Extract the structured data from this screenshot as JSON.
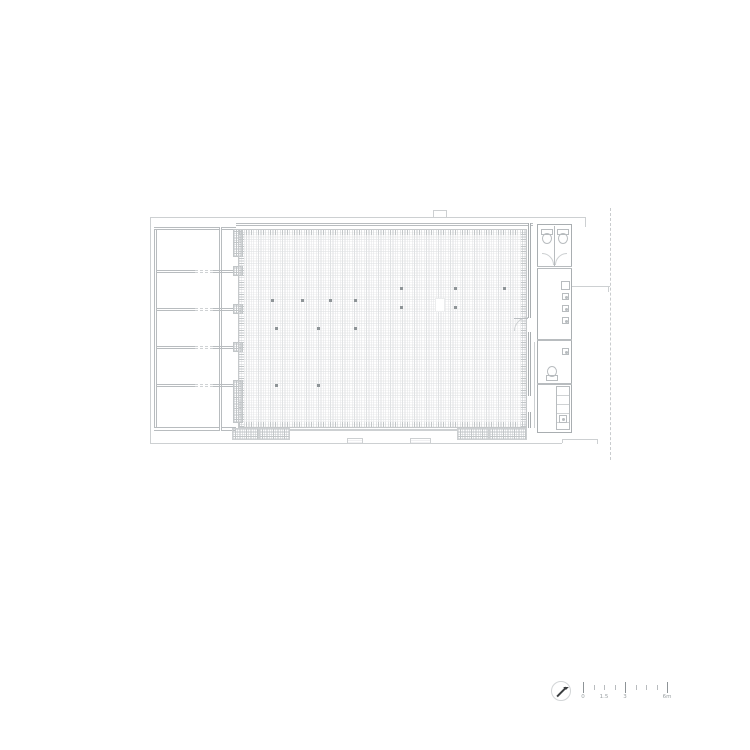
{
  "drawing": {
    "title": "architectural-floor-plan",
    "colors": {
      "outline": "#cdd0d2",
      "wall": "#a9aeb1",
      "wall_mid": "#b8bcbf",
      "wall_light": "#cfd2d4",
      "hatch_line": "#e0e2e4",
      "hatch_faint": "#ecedee",
      "dense": "#c2c6c8",
      "dot": "#8e9497",
      "dashed": "#c9ccce",
      "text": "#9aa0a3",
      "north": "#3a3d3f"
    },
    "hall_column_dots": [
      [
        272,
        300
      ],
      [
        302,
        300
      ],
      [
        330,
        300
      ],
      [
        355,
        300
      ],
      [
        401,
        288
      ],
      [
        455,
        288
      ],
      [
        504,
        288
      ],
      [
        401,
        307
      ],
      [
        455,
        307
      ],
      [
        276,
        328
      ],
      [
        318,
        328
      ],
      [
        355,
        328
      ],
      [
        276,
        385
      ],
      [
        318,
        385
      ]
    ],
    "wing_partition_y": [
      270,
      308,
      346,
      384
    ],
    "pilaster_blocks": [
      [
        229,
        28
      ],
      [
        266,
        10
      ],
      [
        304,
        10
      ],
      [
        342,
        10
      ],
      [
        380,
        43
      ]
    ],
    "facade_blocks": [
      [
        232,
        27
      ],
      [
        259,
        31
      ],
      [
        457,
        32
      ],
      [
        489,
        38
      ]
    ],
    "entry_pads": [
      [
        347,
        16
      ],
      [
        410,
        21
      ]
    ],
    "sink_fixtures": {
      "x": 562,
      "ys": [
        293,
        305,
        317,
        348
      ]
    }
  },
  "scale_bar": {
    "major_ticks_x": [
      583,
      625,
      667
    ],
    "minor_ticks_x": [
      593.5,
      604,
      614.5,
      635.5,
      646,
      656.5
    ],
    "labels": [
      {
        "text": "0",
        "x": 583
      },
      {
        "text": "1.5",
        "x": 604
      },
      {
        "text": "3",
        "x": 625
      },
      {
        "text": "6m",
        "x": 667
      }
    ]
  }
}
